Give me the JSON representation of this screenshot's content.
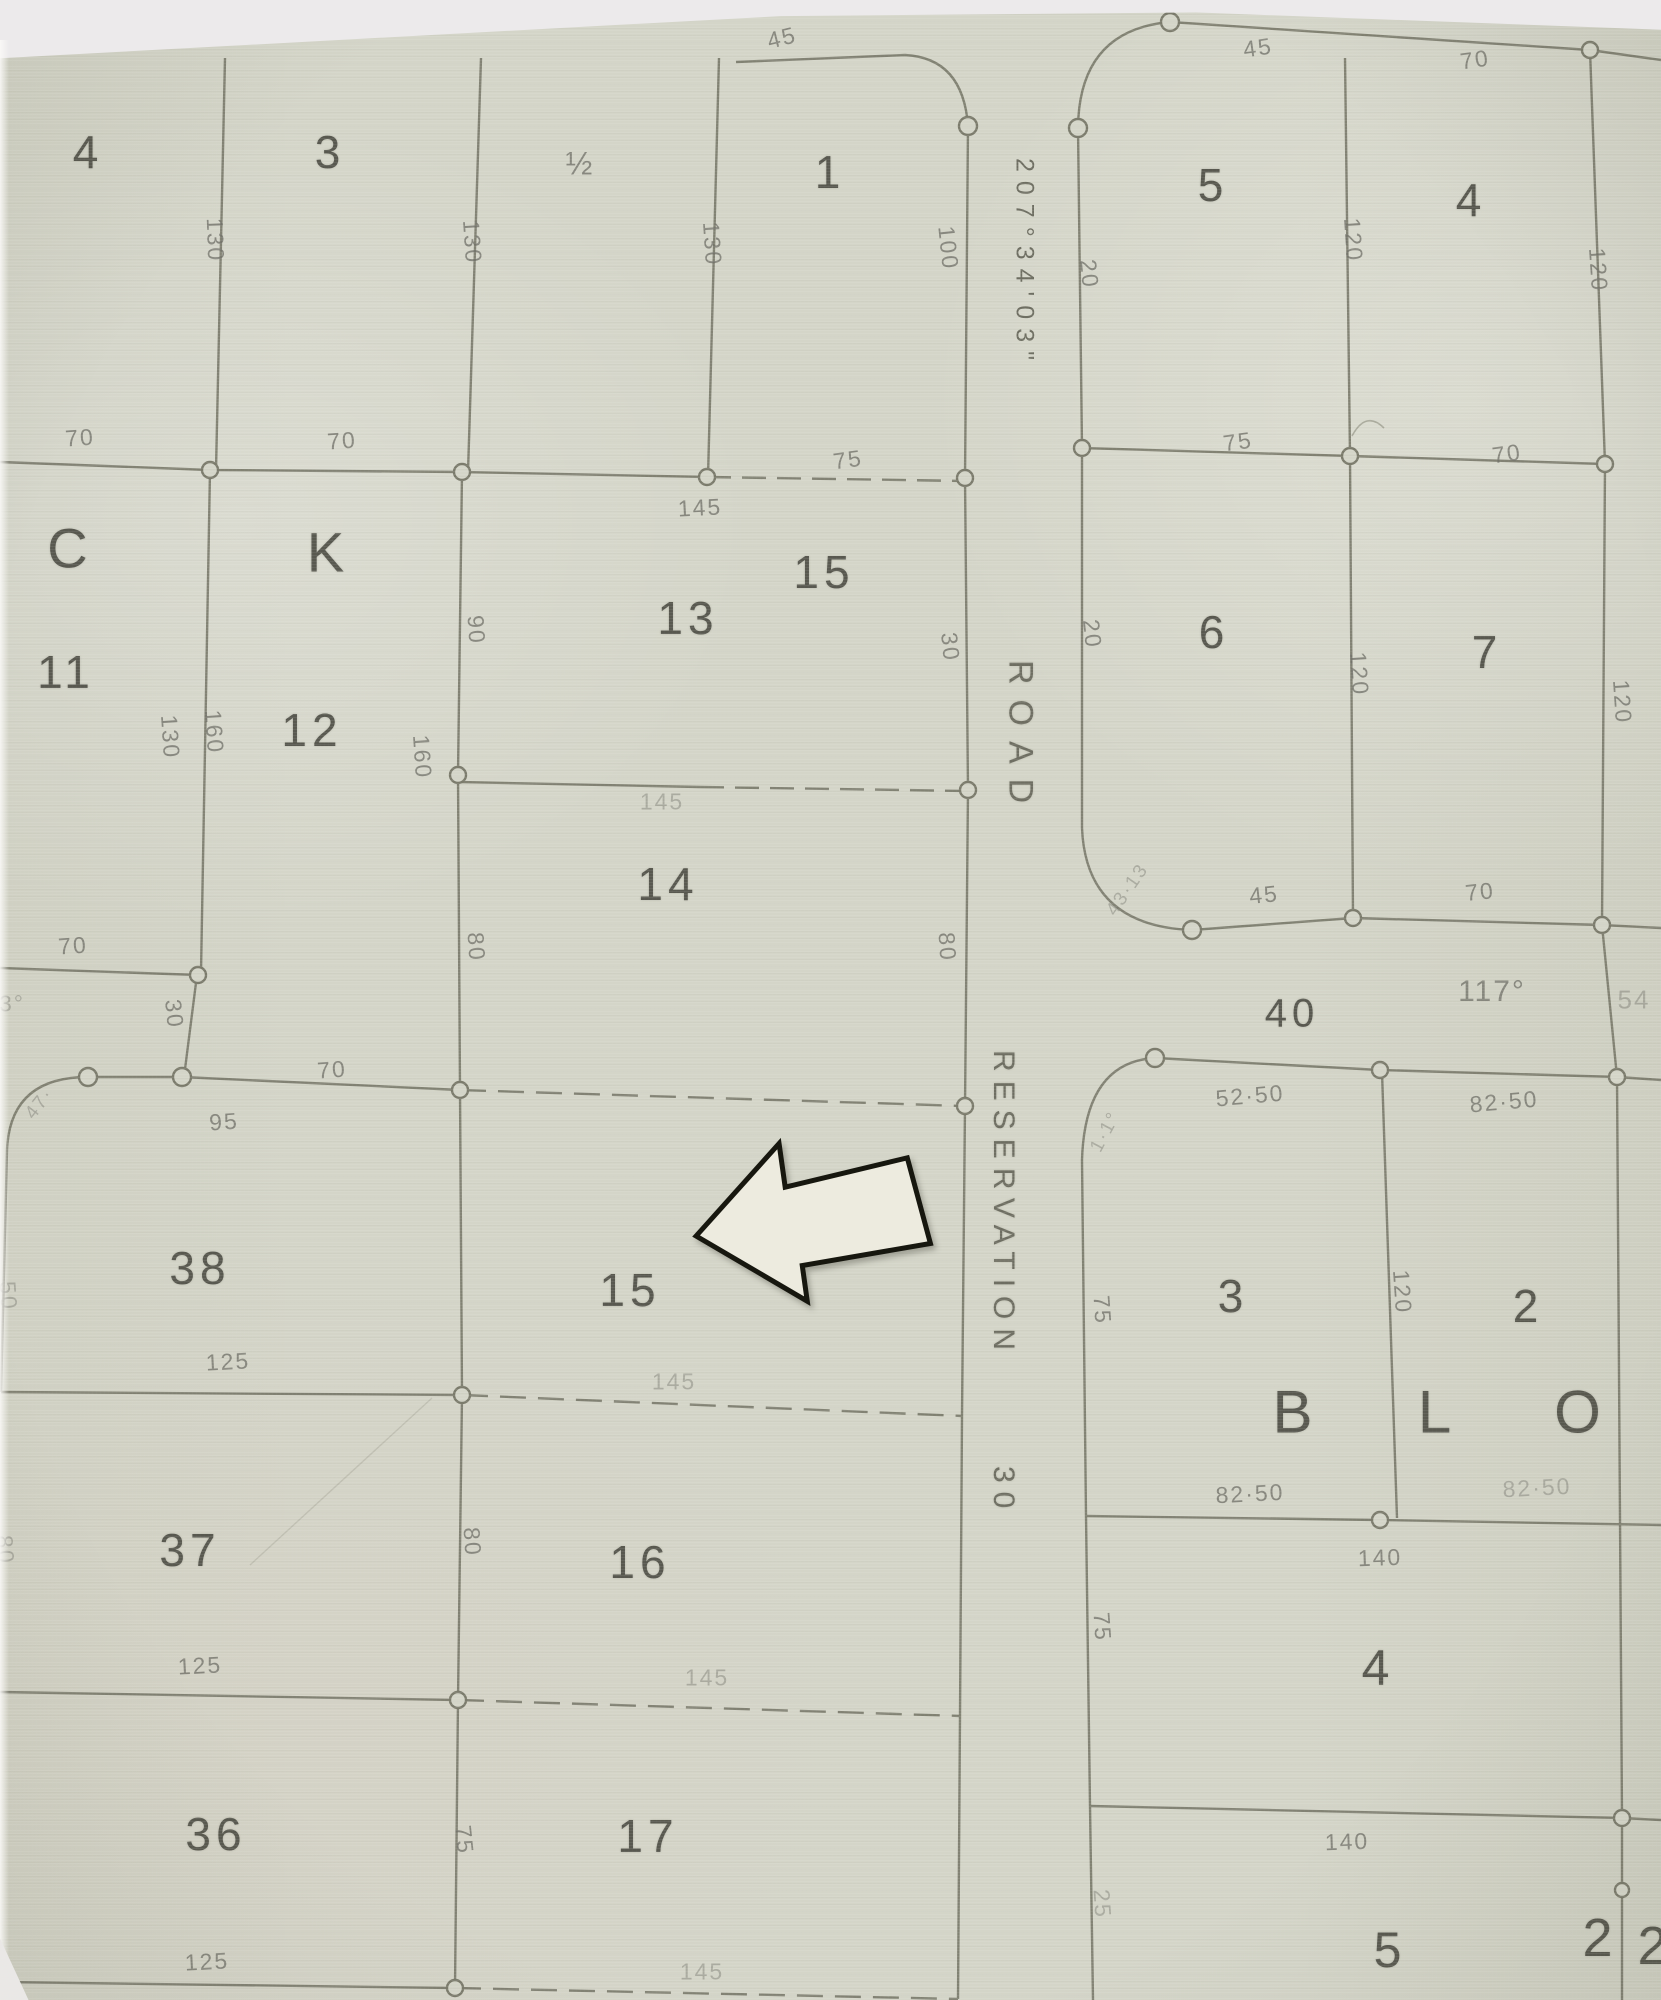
{
  "map": {
    "colors": {
      "paper": "#d4d5c8",
      "line": "#7b7b6c",
      "lot_text": "#4e4e45",
      "measure_text": "#72726a",
      "arrow_fill": "#edebdf",
      "arrow_stroke": "#17170f"
    },
    "road": {
      "name": "ROAD",
      "reservation": "RESERVATION",
      "width": "30",
      "bearing": "207°34'03\""
    },
    "labels": [
      {
        "t": "4",
        "x": 88,
        "y": 152,
        "s": 46,
        "n": "lot-4"
      },
      {
        "t": "3",
        "x": 330,
        "y": 152,
        "s": 46,
        "n": "lot-3"
      },
      {
        "t": "½",
        "x": 580,
        "y": 164,
        "s": 32,
        "c": "m",
        "n": "lot-2-half"
      },
      {
        "t": "1",
        "x": 830,
        "y": 172,
        "s": 46,
        "n": "lot-1"
      },
      {
        "t": "5",
        "x": 1213,
        "y": 185,
        "s": 46,
        "n": "lot-5"
      },
      {
        "t": "4",
        "x": 1471,
        "y": 200,
        "s": 46,
        "n": "lot-4b"
      },
      {
        "t": "C",
        "x": 70,
        "y": 548,
        "s": 56,
        "n": "block-letter-c"
      },
      {
        "t": "K",
        "x": 328,
        "y": 552,
        "s": 56,
        "n": "block-letter-k"
      },
      {
        "t": "11",
        "x": 66,
        "y": 672,
        "s": 46,
        "n": "lot-11"
      },
      {
        "t": "12",
        "x": 312,
        "y": 730,
        "s": 46,
        "n": "lot-12"
      },
      {
        "t": "13",
        "x": 688,
        "y": 618,
        "s": 46,
        "n": "lot-13"
      },
      {
        "t": "15",
        "x": 824,
        "y": 572,
        "s": 46,
        "n": "lot-15a"
      },
      {
        "t": "6",
        "x": 1214,
        "y": 632,
        "s": 46,
        "n": "lot-6"
      },
      {
        "t": "7",
        "x": 1487,
        "y": 652,
        "s": 46,
        "n": "lot-7"
      },
      {
        "t": "14",
        "x": 668,
        "y": 884,
        "s": 46,
        "n": "lot-14"
      },
      {
        "t": "15",
        "x": 630,
        "y": 1290,
        "s": 46,
        "n": "lot-15"
      },
      {
        "t": "16",
        "x": 640,
        "y": 1562,
        "s": 46,
        "n": "lot-16"
      },
      {
        "t": "17",
        "x": 648,
        "y": 1836,
        "s": 46,
        "n": "lot-17"
      },
      {
        "t": "38",
        "x": 200,
        "y": 1268,
        "s": 46,
        "n": "lot-38"
      },
      {
        "t": "37",
        "x": 190,
        "y": 1550,
        "s": 46,
        "n": "lot-37"
      },
      {
        "t": "36",
        "x": 216,
        "y": 1834,
        "s": 46,
        "n": "lot-36"
      },
      {
        "t": "3",
        "x": 1233,
        "y": 1296,
        "s": 46,
        "n": "lot-3b"
      },
      {
        "t": "2",
        "x": 1528,
        "y": 1306,
        "s": 46,
        "n": "lot-2b"
      },
      {
        "t": "B",
        "x": 1295,
        "y": 1412,
        "s": 60,
        "n": "block-letter-b"
      },
      {
        "t": "L",
        "x": 1437,
        "y": 1412,
        "s": 60,
        "n": "block-letter-l"
      },
      {
        "t": "O",
        "x": 1580,
        "y": 1412,
        "s": 60,
        "n": "block-letter-o"
      },
      {
        "t": "4",
        "x": 1378,
        "y": 1668,
        "s": 50,
        "n": "lot-4c"
      },
      {
        "t": "5",
        "x": 1390,
        "y": 1950,
        "s": 50,
        "n": "lot-5b"
      },
      {
        "t": "2",
        "x": 1600,
        "y": 1938,
        "s": 54,
        "n": "lot-2c"
      },
      {
        "t": "2",
        "x": 1655,
        "y": 1946,
        "s": 54,
        "n": "lot-2d"
      },
      {
        "t": "40",
        "x": 1292,
        "y": 1014,
        "s": 40,
        "n": "measure-40"
      },
      {
        "t": "117°",
        "x": 1492,
        "y": 992,
        "s": 30,
        "c": "m",
        "n": "bearing-117"
      },
      {
        "t": "54",
        "x": 1634,
        "y": 1000,
        "s": 26,
        "c": "m faint",
        "n": "bearing-54"
      },
      {
        "t": "70",
        "x": 80,
        "y": 438,
        "r": -4,
        "c": "m"
      },
      {
        "t": "70",
        "x": 342,
        "y": 441,
        "r": -4,
        "c": "m"
      },
      {
        "t": "130",
        "x": 215,
        "y": 240,
        "r": 88,
        "c": "m"
      },
      {
        "t": "130",
        "x": 472,
        "y": 242,
        "r": 86,
        "c": "m"
      },
      {
        "t": "130",
        "x": 712,
        "y": 244,
        "r": 86,
        "c": "m"
      },
      {
        "t": "45",
        "x": 782,
        "y": 38,
        "r": -14,
        "c": "m"
      },
      {
        "t": "45",
        "x": 1258,
        "y": 48,
        "r": -8,
        "c": "m"
      },
      {
        "t": "70",
        "x": 1475,
        "y": 60,
        "r": -8,
        "c": "m"
      },
      {
        "t": "100",
        "x": 948,
        "y": 248,
        "r": 84,
        "c": "m"
      },
      {
        "t": "20",
        "x": 1089,
        "y": 274,
        "r": 84,
        "c": "m"
      },
      {
        "t": "120",
        "x": 1353,
        "y": 240,
        "r": 86,
        "c": "m"
      },
      {
        "t": "120",
        "x": 1598,
        "y": 270,
        "r": 86,
        "c": "m"
      },
      {
        "t": "145",
        "x": 700,
        "y": 508,
        "r": -3,
        "c": "m"
      },
      {
        "t": "75",
        "x": 848,
        "y": 460,
        "r": -8,
        "c": "m"
      },
      {
        "t": "75",
        "x": 1238,
        "y": 442,
        "r": -8,
        "c": "m"
      },
      {
        "t": "70",
        "x": 1507,
        "y": 454,
        "r": -8,
        "c": "m"
      },
      {
        "t": "90",
        "x": 476,
        "y": 630,
        "r": 86,
        "c": "m"
      },
      {
        "t": "20",
        "x": 1092,
        "y": 634,
        "r": 84,
        "c": "m"
      },
      {
        "t": "120",
        "x": 1359,
        "y": 674,
        "r": 86,
        "c": "m"
      },
      {
        "t": "120",
        "x": 1622,
        "y": 702,
        "r": 86,
        "c": "m"
      },
      {
        "t": "130",
        "x": 170,
        "y": 737,
        "r": 86,
        "c": "m"
      },
      {
        "t": "160",
        "x": 214,
        "y": 732,
        "r": 86,
        "c": "m"
      },
      {
        "t": "160",
        "x": 422,
        "y": 757,
        "r": 86,
        "c": "m"
      },
      {
        "t": "80",
        "x": 476,
        "y": 947,
        "r": 86,
        "c": "m"
      },
      {
        "t": "80",
        "x": 947,
        "y": 947,
        "r": 86,
        "c": "m"
      },
      {
        "t": "30",
        "x": 950,
        "y": 647,
        "r": 84,
        "c": "m"
      },
      {
        "t": "145",
        "x": 662,
        "y": 802,
        "c": "m faint"
      },
      {
        "t": "70",
        "x": 73,
        "y": 946,
        "r": -4,
        "c": "m"
      },
      {
        "t": "3°",
        "x": 12,
        "y": 1004,
        "c": "m faint"
      },
      {
        "t": "30",
        "x": 174,
        "y": 1014,
        "r": 84,
        "c": "m"
      },
      {
        "t": "47·",
        "x": 40,
        "y": 1104,
        "r": -52,
        "s": 19,
        "c": "m faint"
      },
      {
        "t": "95",
        "x": 224,
        "y": 1122,
        "r": -4,
        "c": "m"
      },
      {
        "t": "70",
        "x": 332,
        "y": 1070,
        "r": -4,
        "c": "m"
      },
      {
        "t": "50",
        "x": 8,
        "y": 1296,
        "r": 86,
        "c": "m faint"
      },
      {
        "t": "125",
        "x": 228,
        "y": 1362,
        "r": -3,
        "c": "m"
      },
      {
        "t": "145",
        "x": 674,
        "y": 1382,
        "c": "m faint"
      },
      {
        "t": "80",
        "x": 472,
        "y": 1542,
        "r": 86,
        "c": "m"
      },
      {
        "t": "80",
        "x": 5,
        "y": 1550,
        "r": 86,
        "c": "m faint"
      },
      {
        "t": "125",
        "x": 200,
        "y": 1666,
        "r": -3,
        "c": "m"
      },
      {
        "t": "145",
        "x": 707,
        "y": 1678,
        "c": "m faint"
      },
      {
        "t": "75",
        "x": 464,
        "y": 1840,
        "r": 84,
        "c": "m"
      },
      {
        "t": "125",
        "x": 207,
        "y": 1962,
        "r": -3,
        "c": "m"
      },
      {
        "t": "145",
        "x": 702,
        "y": 1972,
        "c": "m faint"
      },
      {
        "t": "45",
        "x": 1264,
        "y": 895,
        "r": -6,
        "c": "m"
      },
      {
        "t": "70",
        "x": 1480,
        "y": 892,
        "r": -6,
        "c": "m"
      },
      {
        "t": "43·13",
        "x": 1128,
        "y": 890,
        "r": -55,
        "s": 19,
        "c": "m faint"
      },
      {
        "t": "52·50",
        "x": 1250,
        "y": 1096,
        "r": -5,
        "c": "m"
      },
      {
        "t": "82·50",
        "x": 1504,
        "y": 1102,
        "r": -5,
        "c": "m"
      },
      {
        "t": "1·1°",
        "x": 1106,
        "y": 1132,
        "r": -62,
        "s": 19,
        "c": "m faint"
      },
      {
        "t": "82·50",
        "x": 1250,
        "y": 1494,
        "r": -3,
        "c": "m"
      },
      {
        "t": "82·50",
        "x": 1537,
        "y": 1488,
        "r": -3,
        "c": "m faint"
      },
      {
        "t": "140",
        "x": 1380,
        "y": 1558,
        "r": -2,
        "c": "m"
      },
      {
        "t": "140",
        "x": 1347,
        "y": 1842,
        "r": -2,
        "c": "m"
      },
      {
        "t": "120",
        "x": 1402,
        "y": 1292,
        "r": 86,
        "c": "m"
      },
      {
        "t": "75",
        "x": 1102,
        "y": 1310,
        "r": 86,
        "c": "m"
      },
      {
        "t": "75",
        "x": 1102,
        "y": 1627,
        "r": 86,
        "c": "m"
      },
      {
        "t": "25",
        "x": 1102,
        "y": 1904,
        "r": 86,
        "c": "m faint"
      },
      {
        "t": "ROAD",
        "x": 1020,
        "y": 660,
        "s": 34,
        "c": "vtext road",
        "n": "road-name"
      },
      {
        "t": "RESERVATION",
        "x": 1003,
        "y": 1050,
        "s": 30,
        "c": "vtext resv",
        "n": "reservation-name"
      },
      {
        "t": "30",
        "x": 1003,
        "y": 1466,
        "s": 30,
        "c": "vtext",
        "n": "reservation-width"
      },
      {
        "t": "207°34'03\"",
        "x": 1024,
        "y": 158,
        "s": 25,
        "c": "vtext m",
        "n": "bearing-207"
      }
    ]
  }
}
